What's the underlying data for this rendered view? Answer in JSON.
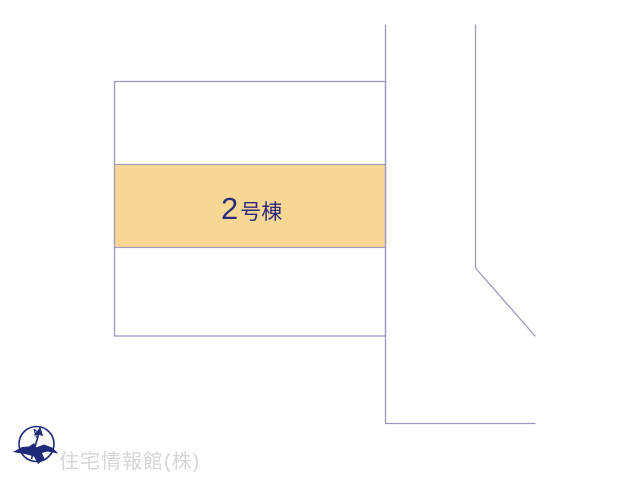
{
  "map": {
    "background_color": "#ffffff",
    "line_color": "#9b99c4",
    "highlighted_parcel": {
      "number": "2",
      "suffix": "号棟",
      "label": "2号棟",
      "fill_color": "#f8d794",
      "label_color": "#2b2b80"
    }
  },
  "compass": {
    "north_label": "N",
    "color": "#1e2a78"
  },
  "watermark": {
    "company": "住宅情報館(株)",
    "color": "#d6d6d6"
  }
}
